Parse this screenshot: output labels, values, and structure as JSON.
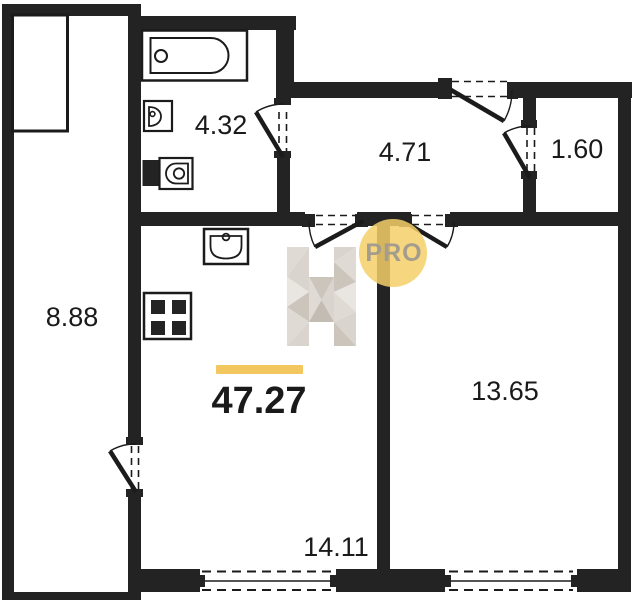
{
  "floor_plan": {
    "total_area": {
      "value": "47.27"
    },
    "badge": {
      "label": "PRO"
    },
    "rooms": [
      {
        "name": "balcony",
        "area": "8.88"
      },
      {
        "name": "bathroom",
        "area": "4.32"
      },
      {
        "name": "hallway",
        "area": "4.71"
      },
      {
        "name": "storage",
        "area": "1.60"
      },
      {
        "name": "bedroom",
        "area": "13.65"
      },
      {
        "name": "living-room-kitchen",
        "area": "14.11"
      }
    ],
    "fixtures": [
      "bathtub",
      "bathroom-sink",
      "toilet",
      "kitchen-sink",
      "stove"
    ],
    "colors": {
      "wall": "#232323",
      "line": "#1b1b1b",
      "text": "#1a1a1a",
      "fixture_fill": "#F9C968",
      "accent": "#F2C75F",
      "badge_fill": "#F5CF69",
      "badge_text": "#A49C8D",
      "wm_a": "#E9E6E1",
      "wm_b": "#D9D4CD",
      "wm_c": "#CBC5BC",
      "wm_d": "#DFDBD4",
      "wm_e": "#C3BCB2"
    }
  }
}
